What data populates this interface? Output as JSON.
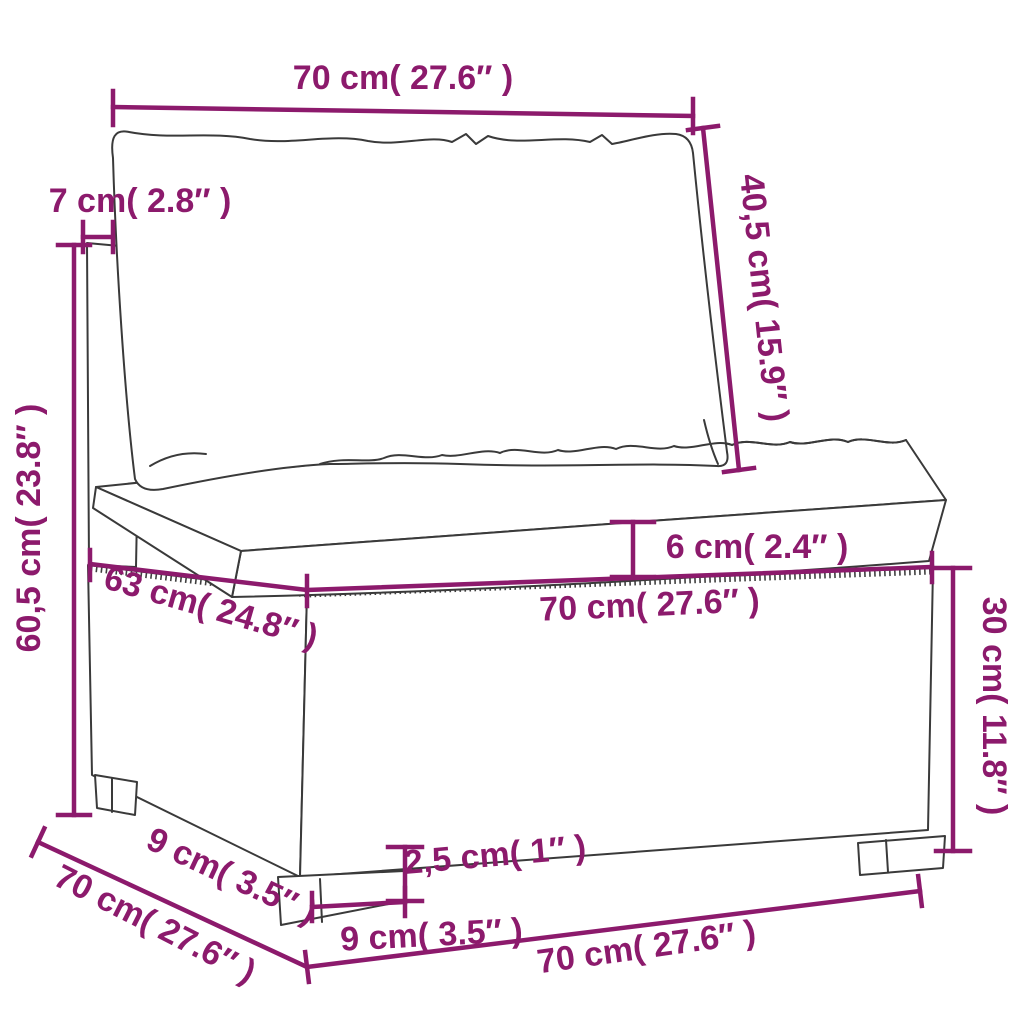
{
  "diagram": {
    "kind": "furniture-dimension-diagram",
    "subject": "poly-rattan middle sofa section with back pillow and seat cushion",
    "colors": {
      "dimension_accent": "#8c1a6c",
      "artwork_line": "#3a3a3a",
      "background": "#ffffff",
      "cushion_fill": "#ffffff"
    },
    "dimensions": {
      "back_cushion_width": "70 cm( 27.6″ )",
      "back_cushion_height": "40,5 cm( 15.9″ )",
      "back_frame_thickness": "7 cm( 2.8″ )",
      "total_height": "60,5 cm( 23.8″ )",
      "seat_top_depth": "63 cm( 24.8″ )",
      "seat_cushion_thickness": "6 cm( 2.4″ )",
      "seat_front_width": "70 cm( 27.6″ )",
      "base_height": "30 cm( 11.8″ )",
      "foot_depth": "9 cm( 3.5″ )",
      "total_depth": "70 cm( 27.6″ )",
      "foot_height": "2,5 cm( 1″ )",
      "foot_width": "9 cm( 3.5″ )",
      "total_width": "70 cm( 27.6″ )"
    }
  }
}
